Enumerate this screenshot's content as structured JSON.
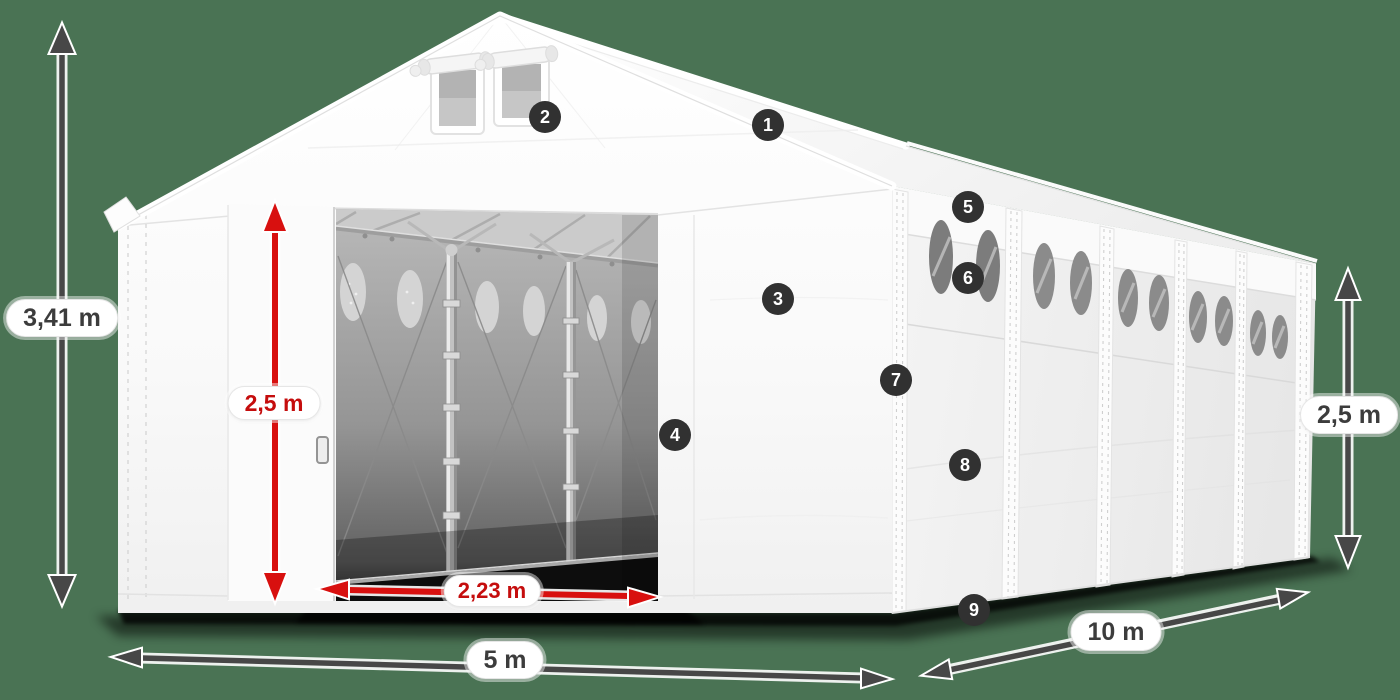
{
  "dimension_labels": {
    "total_height": "3,41 m",
    "entrance_height": "2,5 m",
    "entrance_width": "2,23 m",
    "front_width": "5 m",
    "side_length": "10 m",
    "side_wall_height": "2,5 m"
  },
  "callouts": [
    {
      "label": "1"
    },
    {
      "label": "2"
    },
    {
      "label": "3"
    },
    {
      "label": "4"
    },
    {
      "label": "5"
    },
    {
      "label": "6"
    },
    {
      "label": "7"
    },
    {
      "label": "8"
    },
    {
      "label": "9"
    }
  ],
  "colors": {
    "background": "#4a7354",
    "dimension_arrow_dark": "#474747",
    "dimension_arrow_red": "#d8100f",
    "label_pill_background": "#ffffff",
    "label_text_dark": "#3c3c3c",
    "label_text_red": "#c50d0d",
    "callout_badge_background": "#313131",
    "callout_badge_text": "#ffffff",
    "tent_fabric": "#ffffff",
    "interior_wall": "#9a9a9a"
  }
}
